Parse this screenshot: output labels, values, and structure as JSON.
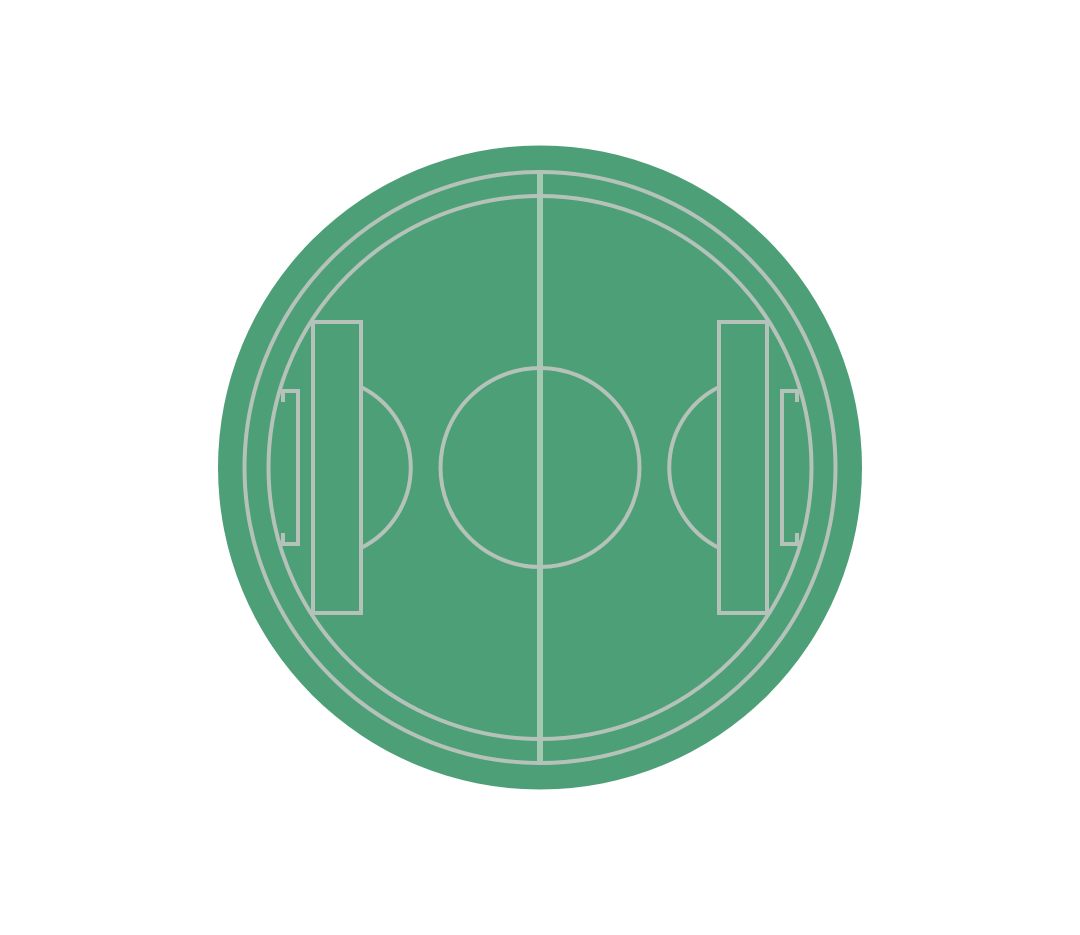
{
  "icon": {
    "label": "soccer-pitch-badge",
    "colors": {
      "background": "#ffffff",
      "field": "#4c9f76",
      "lines": "#b5c2b9",
      "halfway_line": "#a3c9b3"
    },
    "pitch": {
      "canvas": {
        "width": 1080,
        "height": 935
      },
      "center": {
        "x": 540,
        "y": 467.5
      },
      "disc_radius": 322,
      "ring_radii": [
        295.5,
        271.5
      ],
      "stroke_width": 4,
      "halfway_line": {
        "x": 540,
        "y1": 172,
        "y2": 763,
        "stroke_width": 6
      },
      "center_circle_radius": 99.5,
      "penalty_boxes": [
        {
          "x": 313,
          "y": 322,
          "width": 48,
          "height": 291
        },
        {
          "x": 719,
          "y": 322,
          "width": 48,
          "height": 291
        }
      ],
      "goal_boxes": [
        {
          "outer_x": 283,
          "inner_x": 298,
          "y1": 391,
          "y2": 544,
          "stub": 11
        },
        {
          "outer_x": 797,
          "inner_x": 782,
          "y1": 391,
          "y2": 544,
          "stub": 11
        }
      ],
      "penalty_arcs": [
        {
          "attach_x": 361,
          "y1": 387,
          "y2": 548,
          "radius": 90,
          "sweep": 1
        },
        {
          "attach_x": 719,
          "y1": 387,
          "y2": 548,
          "radius": 90,
          "sweep": 0
        }
      ]
    }
  }
}
